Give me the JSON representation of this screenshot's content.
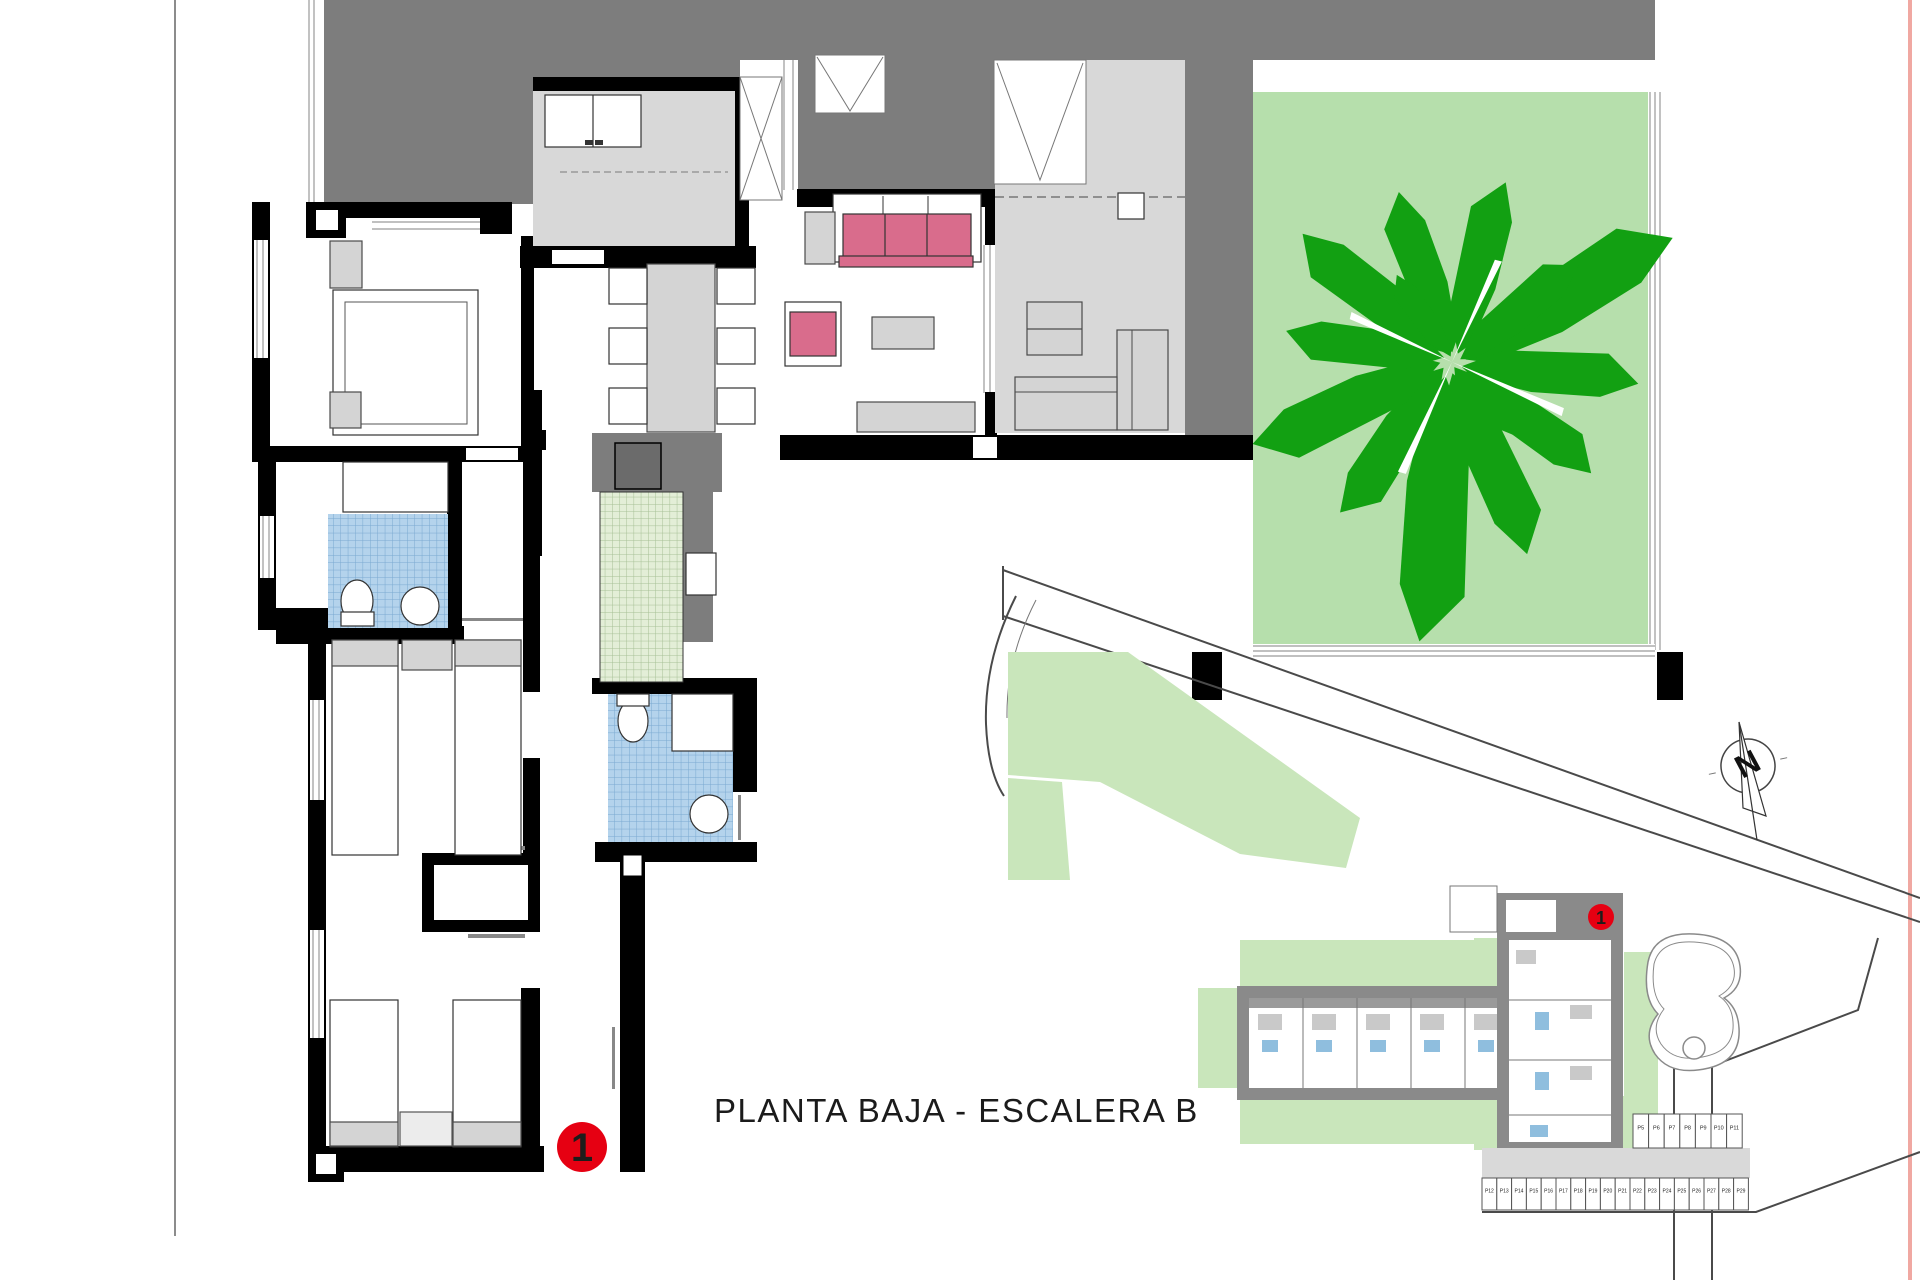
{
  "title": "PLANTA BAJA - ESCALERA B",
  "floor_plan_marker": "1",
  "site_plan": {
    "building_marker": "1",
    "north_letter": "N",
    "parking_row_upper": [
      "P5",
      "P6",
      "P7",
      "P8",
      "P9",
      "P10",
      "P11"
    ],
    "parking_row_lower": [
      "P12",
      "P13",
      "P14",
      "P15",
      "P16",
      "P17",
      "P18",
      "P19",
      "P20",
      "P21",
      "P22",
      "P23",
      "P24",
      "P25",
      "P26",
      "P27",
      "P28",
      "P29"
    ]
  },
  "colors": {
    "terrace-gray": "#7d7d7d",
    "room-gray": "#d8d8d8",
    "furniture-gray": "#d4d4d4",
    "furniture-stroke": "#4a4a4a",
    "wall-black": "#000000",
    "garden-green": "#b6dfac",
    "tree-green": "#12a012",
    "tile-blue": "#b4d3ec",
    "tile-blue-line": "#7aa9d1",
    "tile-green": "#e3eed7",
    "tile-green-line": "#a6bf95",
    "sofa-pink": "#d96c8c",
    "marker-red": "#e60012",
    "site-green": "#c9e6bb",
    "site-gray": "#8a8a8a",
    "paving-gray": "#d9d9d9",
    "line-gray": "#4a4a4a",
    "edge-pink": "#f0a8a2",
    "glass-line": "#9a9a9a"
  }
}
